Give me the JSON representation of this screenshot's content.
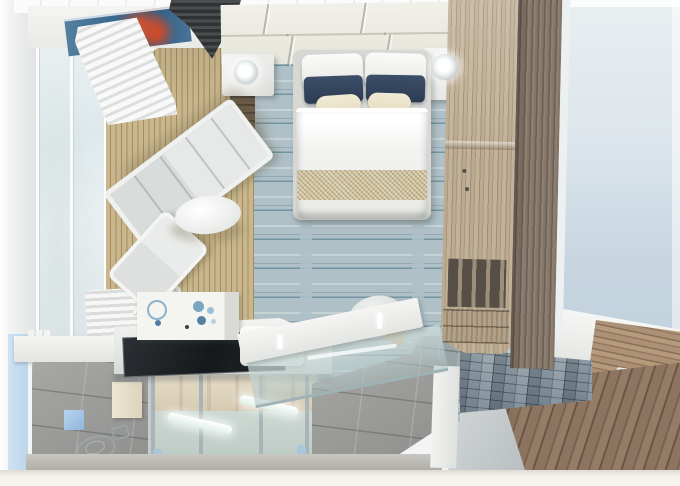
{
  "scene": {
    "kind": "3d-floorplan-render",
    "description": "Top-down cutaway 3D rendering of a cruise-ship cabin with veranda, bedroom, desk-vanity, bathroom and exterior corridor",
    "visible_text": "none"
  },
  "labels": {
    "scene": "Cruise cabin 3D floor plan (top-down cutaway render)",
    "veranda_deck": "Veranda wood-slat deck",
    "lounger": "White lounger on veranda",
    "chair": "White veranda chair",
    "table": "Oval white table",
    "window_wall": "Floor-to-ceiling window wall",
    "blinds": "Bunched white roman blinds",
    "carpet": "Blue-grey striped bedroom carpet",
    "bed": "Queen bed with white duvet and gold runner",
    "pillow_white": "White pillow",
    "pillow_navy": "Navy accent pillow",
    "pillow_cream": "Cream accent pillow",
    "headboard": "Tufted cream headboard wall",
    "nightstand_left": "Left nightstand",
    "nightstand_right": "Right nightstand",
    "lamp": "Glowing bedside lamp",
    "artwork": "Blue abstract artwork with red accents",
    "vent": "Dark louvered vent / partition header",
    "divider": "Dark wood partition post",
    "wardrobe": "Wood wardrobe and shelving unit",
    "desk": "White desk / vanity counter",
    "desk_mat": "Black glass desk panel",
    "cabinet": "Vanity cabinet with blue decor",
    "sink": "White sink basin",
    "desk_chair": "Desk stool",
    "bathroom": "Bathroom (cutaway)",
    "shower": "Glass shower enclosure with lit bars",
    "toilet": "Toilet (transparent wireframe render)",
    "glass_partition": "Angled glass bathroom partition",
    "corridor": "Ship corridor with wood plank floor",
    "cabin_door": "Cabin entry door with chrome handle",
    "mosaic_wall": "Blue-grey mosaic tile wall",
    "entry_floor": "Grey stone entry tiles",
    "backdrop": "Pale blue exterior backdrop"
  },
  "colors": {
    "bg-right-bottom": "#b9ccd9",
    "deck": "#c9b68c",
    "deck-line": "#a28d62",
    "carpet": "#afc0c7",
    "carpet-streak": "#3f6e82",
    "wood-light": "#bcab92",
    "wood-dark": "#6c6054",
    "pillow-navy": "#2b3b52",
    "pillow-cream": "#e5ddbf",
    "runner": "#c9bb95",
    "headboard": "#e6e5db",
    "art-blue": "#3c6b92",
    "art-red": "#c64b2e",
    "louver": "#2f3233",
    "black-glass": "#15191c",
    "mosaic": "#8694a0",
    "corridor-wood": "#8d7460",
    "door-wood": "#ad9177",
    "tile": "#9d9e9c",
    "outer-blue": "#cfe3f3",
    "chrome": "#b9c2c6",
    "decor-blue": "#8fb2cb",
    "shower-beige": "#d5cab2"
  }
}
